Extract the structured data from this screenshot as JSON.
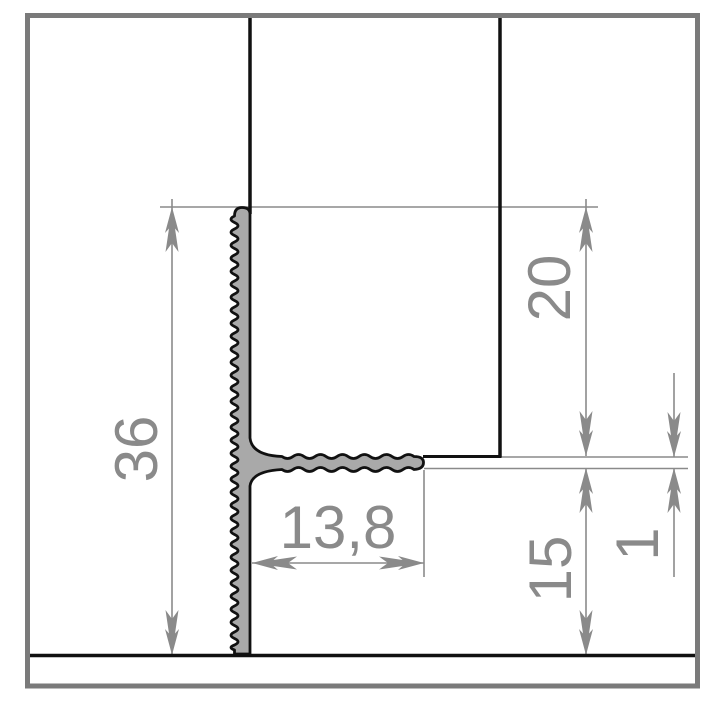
{
  "drawing": {
    "description": "Technical cross-section drawing of an aluminium tile-edge trim profile between wall tile and floor",
    "dims": {
      "total_height": "36",
      "upper_leg_height": "20",
      "flange_width": "13,8",
      "lower_gap": "15",
      "material_thickness": "1"
    }
  },
  "colors": {
    "frame": "#7a7a7a",
    "outline": "#111111",
    "profile_fill": "#a9a9a9",
    "dimension": "#8a8a8a",
    "background": "#ffffff"
  }
}
